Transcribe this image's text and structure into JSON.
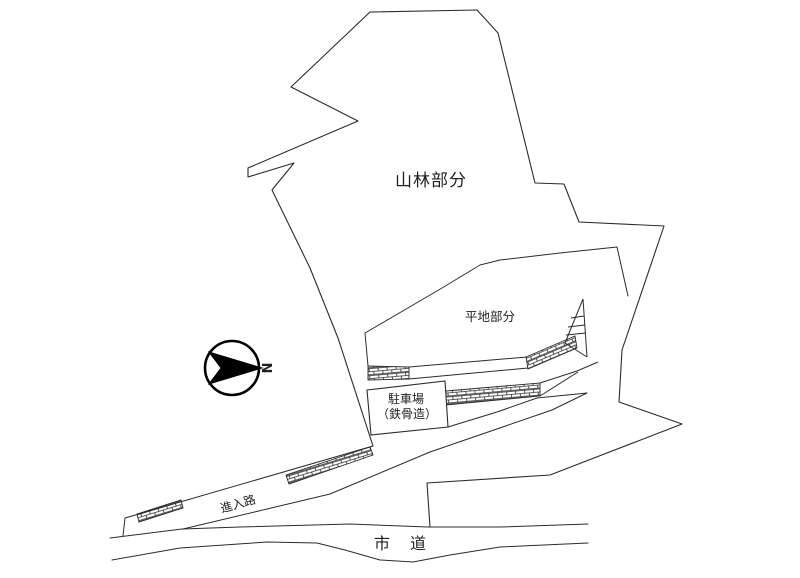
{
  "page": {
    "background_color": "#ffffff",
    "line_color": "#2b2b2b",
    "north_fill_color": "#000000"
  },
  "labels": {
    "forest_area": "山林部分",
    "flat_area": "平地部分",
    "parking_name": "駐車場",
    "parking_structure": "（鉄骨造）",
    "approach_road": "進入路",
    "city_road": "市　道",
    "north_mark": "N"
  }
}
